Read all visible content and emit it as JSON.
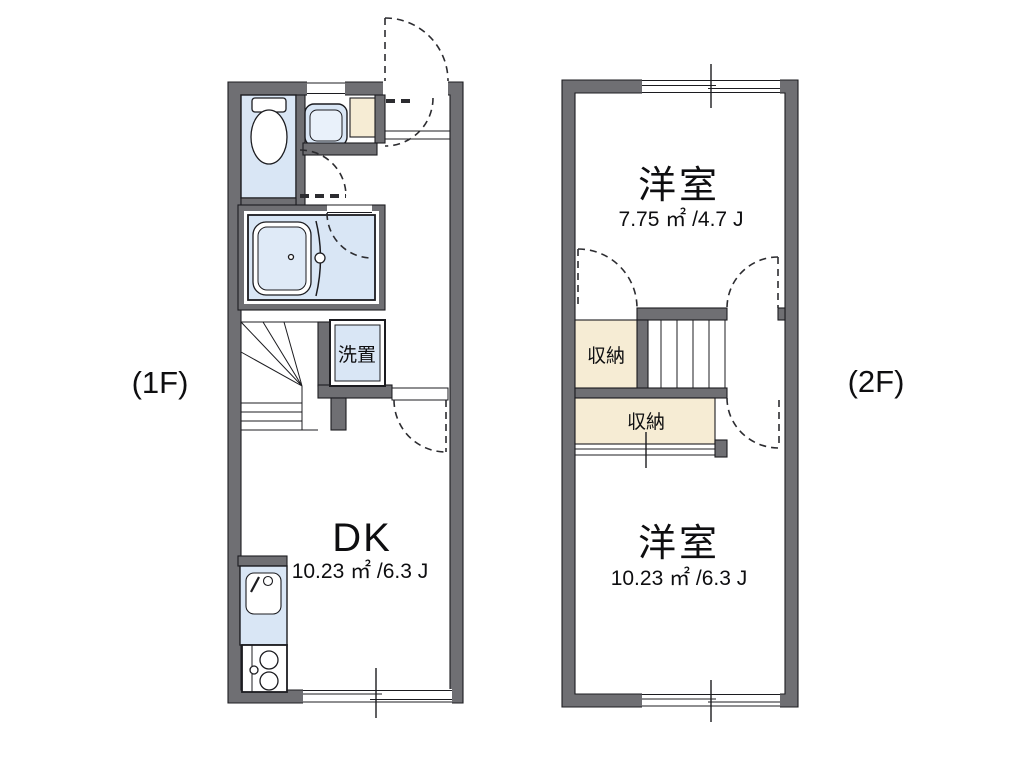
{
  "floor_1f": {
    "label": "(1F)",
    "dk_room": {
      "name": "DK",
      "area": "10.23 ㎡ /6.3 J"
    },
    "laundry_space": {
      "name": "洗置"
    }
  },
  "floor_2f": {
    "label": "(2F)",
    "north_room": {
      "name": "洋室",
      "area": "7.75 ㎡ /4.7 J"
    },
    "south_room": {
      "name": "洋室",
      "area": "10.23 ㎡ /6.3 J"
    },
    "north_closet": {
      "name": "収納"
    },
    "south_closet": {
      "name": "収納"
    }
  },
  "colors": {
    "wall_gray": "#6f6f73",
    "wet_area_blue": "#d9e6f5",
    "storage_beige": "#f6ecd4",
    "line_black": "#1c1c20",
    "background": "#ffffff"
  }
}
